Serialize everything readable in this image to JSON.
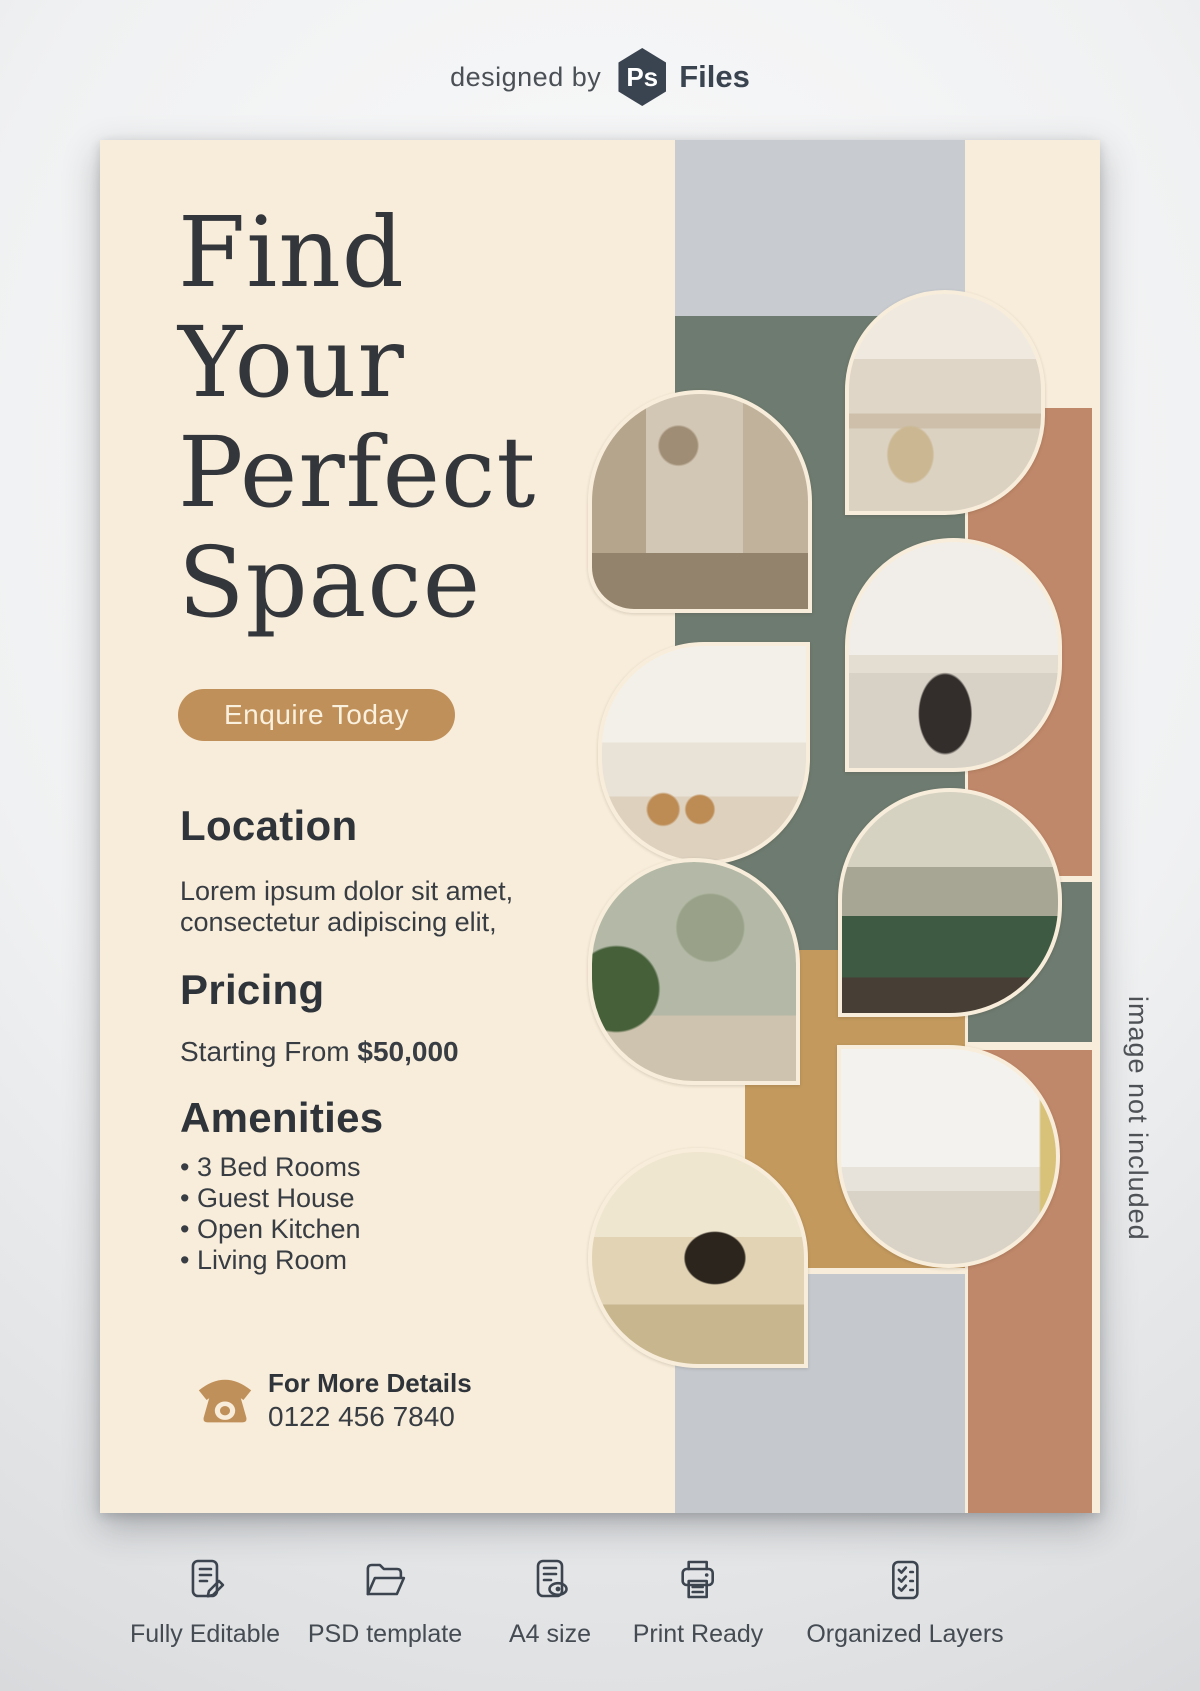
{
  "header": {
    "prefix": "designed by",
    "logo": {
      "monogram": "Ps",
      "name": "Files"
    }
  },
  "flyer": {
    "title_lines": [
      "Find",
      "Your",
      "Perfect",
      "Space"
    ],
    "cta_label": "Enquire Today",
    "location": {
      "heading": "Location",
      "body_line1": "Lorem ipsum dolor sit amet,",
      "body_line2": "consectetur adipiscing elit,"
    },
    "pricing": {
      "heading": "Pricing",
      "prefix": "Starting From",
      "price": "$50,000"
    },
    "amenities": {
      "heading": "Amenities",
      "items": [
        "3 Bed Rooms",
        "Guest House",
        "Open Kitchen",
        "Living Room"
      ]
    },
    "contact": {
      "heading": "For More Details",
      "phone": "0122 456 7840"
    },
    "photos": [
      {
        "label": "living room with pendant lamp and wood slat wall"
      },
      {
        "label": "open plan living room with curved white sofa"
      },
      {
        "label": "white kitchen with wooden bar stools"
      },
      {
        "label": "living room with white sectional sofa and black ottoman"
      },
      {
        "label": "living room with green velvet sofa and large windows"
      },
      {
        "label": "hallway console with round mirror and plant"
      },
      {
        "label": "bright living room with beige sofas and coffee table"
      },
      {
        "label": "family lounge with tv wall and patterned rug"
      }
    ],
    "colors": {
      "cream": "#f8edda",
      "tan_accent": "#c0905a",
      "sage_green": "#6e7b70",
      "terracotta": "#c0886a",
      "mustard": "#c3995e",
      "light_gray": "#c8ccd1",
      "ink": "#33363b"
    }
  },
  "watermark": "image not included",
  "features": [
    {
      "icon": "document-edit-icon",
      "label": "Fully Editable"
    },
    {
      "icon": "folder-open-icon",
      "label": "PSD template"
    },
    {
      "icon": "document-preview-icon",
      "label": "A4 size"
    },
    {
      "icon": "printer-icon",
      "label": "Print Ready"
    },
    {
      "icon": "checklist-icon",
      "label": "Organized Layers"
    }
  ]
}
